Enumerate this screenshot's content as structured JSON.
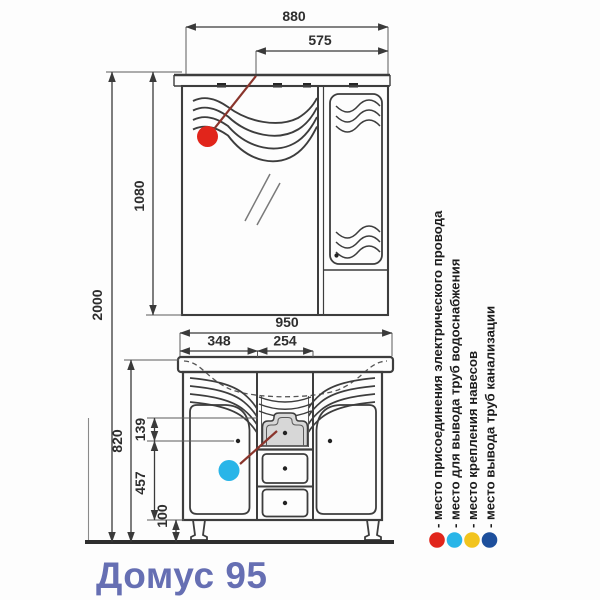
{
  "title": "Домус 95",
  "title_color": "#666fb3",
  "dimensions": {
    "cabinet_width": "880",
    "light_position": "575",
    "cabinet_height": "1080",
    "total_height": "2000",
    "vanity_width": "950",
    "left_section_width": "348",
    "center_section_width": "254",
    "upper_zone_height": "139",
    "vanity_height": "820",
    "door_zone_height": "457",
    "leg_height": "100"
  },
  "markers": {
    "leader_color": "#8a352c"
  },
  "legend": {
    "items": [
      {
        "name": "electric",
        "color": "#e1251b",
        "label": "- место присоединения электрического провода"
      },
      {
        "name": "water-supply",
        "color": "#29b5e8",
        "label": "- место для вывода труб водоснабжения"
      },
      {
        "name": "mounting",
        "color": "#f2c41e",
        "label": "- место крепления навесов"
      },
      {
        "name": "sewage",
        "color": "#1d4f9c",
        "label": "- место вывода труб канализации"
      }
    ]
  }
}
